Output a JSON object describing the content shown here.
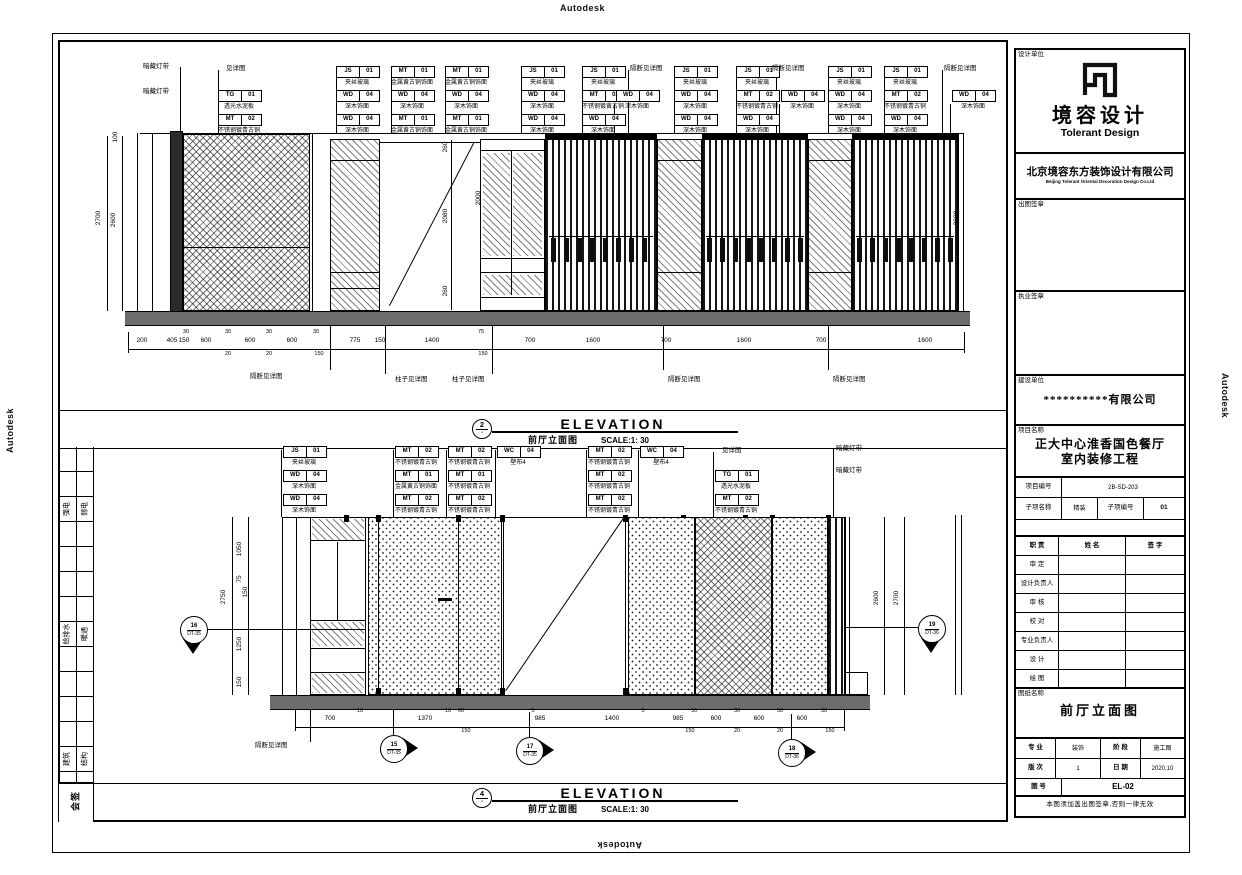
{
  "watermarks": {
    "top": "Autodesk",
    "bottom": "Autodesk",
    "left": "Autodesk",
    "right": "Autodesk"
  },
  "elev1": {
    "title": {
      "num": "2",
      "dash": "-",
      "en": "ELEVATION",
      "zh": "前厅立面图",
      "scale": "SCALE:1: 30"
    },
    "tags": [
      {
        "x": 218,
        "y": 90,
        "code": "TG",
        "num": "01",
        "label": "透光水泥板"
      },
      {
        "x": 218,
        "y": 114,
        "code": "MT",
        "num": "02",
        "label": "不锈钢镀青古铜"
      },
      {
        "x": 336,
        "y": 66,
        "code": "JS",
        "num": "01",
        "label": "夹丝玻璃"
      },
      {
        "x": 336,
        "y": 90,
        "code": "WD",
        "num": "04",
        "label": "深木饰面"
      },
      {
        "x": 336,
        "y": 114,
        "code": "WD",
        "num": "04",
        "label": "深木饰面"
      },
      {
        "x": 391,
        "y": 66,
        "code": "MT",
        "num": "01",
        "label": "金属黄古铜饰面"
      },
      {
        "x": 391,
        "y": 90,
        "code": "WD",
        "num": "04",
        "label": "深木饰面"
      },
      {
        "x": 391,
        "y": 114,
        "code": "MT",
        "num": "01",
        "label": "金属黄古铜饰面"
      },
      {
        "x": 445,
        "y": 66,
        "code": "MT",
        "num": "01",
        "label": "金属黄古铜饰面"
      },
      {
        "x": 445,
        "y": 90,
        "code": "WD",
        "num": "04",
        "label": "深木饰面"
      },
      {
        "x": 445,
        "y": 114,
        "code": "MT",
        "num": "01",
        "label": "金属黄古铜饰面"
      },
      {
        "x": 521,
        "y": 66,
        "code": "JS",
        "num": "01",
        "label": "夹丝玻璃"
      },
      {
        "x": 521,
        "y": 90,
        "code": "WD",
        "num": "04",
        "label": "深木饰面"
      },
      {
        "x": 521,
        "y": 114,
        "code": "WD",
        "num": "04",
        "label": "深木饰面"
      },
      {
        "x": 582,
        "y": 66,
        "code": "JS",
        "num": "01",
        "label": "夹丝玻璃"
      },
      {
        "x": 582,
        "y": 90,
        "code": "MT",
        "num": "02",
        "label": "不锈钢镀黄古铜"
      },
      {
        "x": 582,
        "y": 114,
        "code": "WD",
        "num": "04",
        "label": "深木饰面"
      },
      {
        "x": 616,
        "y": 90,
        "code": "WD",
        "num": "04",
        "label": "深木饰面"
      },
      {
        "x": 674,
        "y": 66,
        "code": "JS",
        "num": "01",
        "label": "夹丝玻璃"
      },
      {
        "x": 674,
        "y": 90,
        "code": "WD",
        "num": "04",
        "label": "深木饰面"
      },
      {
        "x": 674,
        "y": 114,
        "code": "WD",
        "num": "04",
        "label": "深木饰面"
      },
      {
        "x": 736,
        "y": 66,
        "code": "JS",
        "num": "01",
        "label": "夹丝玻璃"
      },
      {
        "x": 736,
        "y": 90,
        "code": "MT",
        "num": "02",
        "label": "不锈钢镀青古铜"
      },
      {
        "x": 736,
        "y": 114,
        "code": "WD",
        "num": "04",
        "label": "深木饰面"
      },
      {
        "x": 781,
        "y": 90,
        "code": "WD",
        "num": "04",
        "label": "深木饰面"
      },
      {
        "x": 828,
        "y": 66,
        "code": "JS",
        "num": "01",
        "label": "夹丝玻璃"
      },
      {
        "x": 828,
        "y": 90,
        "code": "WD",
        "num": "04",
        "label": "深木饰面"
      },
      {
        "x": 828,
        "y": 114,
        "code": "WD",
        "num": "04",
        "label": "深木饰面"
      },
      {
        "x": 884,
        "y": 66,
        "code": "JS",
        "num": "01",
        "label": "夹丝玻璃"
      },
      {
        "x": 884,
        "y": 90,
        "code": "MT",
        "num": "02",
        "label": "不锈钢镀青古铜"
      },
      {
        "x": 884,
        "y": 114,
        "code": "WD",
        "num": "04",
        "label": "深木饰面"
      },
      {
        "x": 952,
        "y": 90,
        "code": "WD",
        "num": "04",
        "label": "深木饰面"
      }
    ],
    "notes": [
      {
        "x": 143,
        "y": 64,
        "t": "暗藏灯带"
      },
      {
        "x": 143,
        "y": 89,
        "t": "暗藏灯带"
      },
      {
        "x": 226,
        "y": 66,
        "t": "见详图"
      },
      {
        "x": 630,
        "y": 66,
        "t": "隔断见详图"
      },
      {
        "x": 772,
        "y": 66,
        "t": "隔断见详图"
      },
      {
        "x": 944,
        "y": 66,
        "t": "隔断见详图"
      }
    ],
    "dims": [
      {
        "x": 142,
        "y": 338,
        "t": "200"
      },
      {
        "x": 172,
        "y": 338,
        "t": "405"
      },
      {
        "x": 184,
        "y": 338,
        "t": "150"
      },
      {
        "x": 206,
        "y": 338,
        "t": "600"
      },
      {
        "x": 250,
        "y": 338,
        "t": "600"
      },
      {
        "x": 292,
        "y": 338,
        "t": "600"
      },
      {
        "x": 355,
        "y": 338,
        "t": "775"
      },
      {
        "x": 380,
        "y": 338,
        "t": "150"
      },
      {
        "x": 432,
        "y": 338,
        "t": "1400"
      },
      {
        "x": 530,
        "y": 338,
        "t": "700"
      },
      {
        "x": 593,
        "y": 338,
        "t": "1600"
      },
      {
        "x": 666,
        "y": 338,
        "t": "700"
      },
      {
        "x": 744,
        "y": 338,
        "t": "1600"
      },
      {
        "x": 821,
        "y": 338,
        "t": "700"
      },
      {
        "x": 925,
        "y": 338,
        "t": "1600"
      },
      {
        "x": 186,
        "y": 330,
        "t": "30",
        "cls": "sm"
      },
      {
        "x": 228,
        "y": 330,
        "t": "30",
        "cls": "sm"
      },
      {
        "x": 269,
        "y": 330,
        "t": "30",
        "cls": "sm"
      },
      {
        "x": 316,
        "y": 330,
        "t": "30",
        "cls": "sm"
      },
      {
        "x": 481,
        "y": 330,
        "t": "75",
        "cls": "sm"
      },
      {
        "x": 228,
        "y": 352,
        "t": "20",
        "cls": "sm"
      },
      {
        "x": 269,
        "y": 352,
        "t": "20",
        "cls": "sm"
      },
      {
        "x": 319,
        "y": 352,
        "t": "150",
        "cls": "sm"
      },
      {
        "x": 483,
        "y": 352,
        "t": "150",
        "cls": "sm"
      }
    ],
    "vdims": [
      {
        "x": 99,
        "y": 218,
        "t": "2700"
      },
      {
        "x": 114,
        "y": 220,
        "t": "2600"
      },
      {
        "x": 116,
        "y": 137,
        "t": "100"
      },
      {
        "x": 446,
        "y": 147,
        "t": "260"
      },
      {
        "x": 446,
        "y": 216,
        "t": "2080"
      },
      {
        "x": 446,
        "y": 291,
        "t": "260"
      },
      {
        "x": 479,
        "y": 198,
        "t": "2000"
      },
      {
        "x": 957,
        "y": 218,
        "t": "2600"
      }
    ],
    "below_notes": [
      {
        "x": 250,
        "y": 374,
        "t": "隔断见详图"
      },
      {
        "x": 395,
        "y": 377,
        "t": "柱子见详图"
      },
      {
        "x": 452,
        "y": 377,
        "t": "柱子见详图"
      },
      {
        "x": 668,
        "y": 377,
        "t": "隔断见详图"
      },
      {
        "x": 833,
        "y": 377,
        "t": "隔断见详图"
      }
    ]
  },
  "elev2": {
    "title": {
      "num": "4",
      "dash": "-",
      "en": "ELEVATION",
      "zh": "前厅立面图",
      "scale": "SCALE:1: 30"
    },
    "tags": [
      {
        "x": 283,
        "y": 446,
        "code": "JS",
        "num": "01",
        "label": "夹丝玻璃"
      },
      {
        "x": 283,
        "y": 470,
        "code": "WD",
        "num": "04",
        "label": "深木饰面"
      },
      {
        "x": 283,
        "y": 494,
        "code": "WD",
        "num": "04",
        "label": "深木饰面"
      },
      {
        "x": 395,
        "y": 446,
        "code": "MT",
        "num": "02",
        "label": "不锈钢镀青古铜"
      },
      {
        "x": 395,
        "y": 470,
        "code": "MT",
        "num": "01",
        "label": "金属黄古铜饰面"
      },
      {
        "x": 395,
        "y": 494,
        "code": "MT",
        "num": "02",
        "label": "不锈钢镀青古铜"
      },
      {
        "x": 448,
        "y": 446,
        "code": "MT",
        "num": "02",
        "label": "不锈钢镀青古铜"
      },
      {
        "x": 448,
        "y": 470,
        "code": "MT",
        "num": "01",
        "label": "不锈钢镀青古铜"
      },
      {
        "x": 448,
        "y": 494,
        "code": "MT",
        "num": "02",
        "label": "不锈钢镀青古铜"
      },
      {
        "x": 497,
        "y": 446,
        "code": "WC",
        "num": "04",
        "label": "壁布4"
      },
      {
        "x": 588,
        "y": 446,
        "code": "MT",
        "num": "02",
        "label": "不锈钢镀青古铜"
      },
      {
        "x": 588,
        "y": 470,
        "code": "MT",
        "num": "02",
        "label": "不锈钢镀青古铜"
      },
      {
        "x": 588,
        "y": 494,
        "code": "MT",
        "num": "02",
        "label": "不锈钢镀青古铜"
      },
      {
        "x": 640,
        "y": 446,
        "code": "WC",
        "num": "04",
        "label": "壁布4"
      },
      {
        "x": 715,
        "y": 470,
        "code": "TG",
        "num": "01",
        "label": "透光水泥板"
      },
      {
        "x": 715,
        "y": 494,
        "code": "MT",
        "num": "02",
        "label": "不锈钢镀青古铜"
      }
    ],
    "notes": [
      {
        "x": 722,
        "y": 448,
        "t": "见详图"
      },
      {
        "x": 836,
        "y": 446,
        "t": "暗藏灯带"
      },
      {
        "x": 836,
        "y": 468,
        "t": "暗藏灯带"
      }
    ],
    "dims": [
      {
        "x": 330,
        "y": 716,
        "t": "700"
      },
      {
        "x": 425,
        "y": 716,
        "t": "1370"
      },
      {
        "x": 540,
        "y": 716,
        "t": "985"
      },
      {
        "x": 612,
        "y": 716,
        "t": "1400"
      },
      {
        "x": 678,
        "y": 716,
        "t": "985"
      },
      {
        "x": 716,
        "y": 716,
        "t": "600"
      },
      {
        "x": 759,
        "y": 716,
        "t": "600"
      },
      {
        "x": 802,
        "y": 716,
        "t": "600"
      },
      {
        "x": 360,
        "y": 709,
        "t": "10",
        "cls": "sm"
      },
      {
        "x": 448,
        "y": 709,
        "t": "10",
        "cls": "sm"
      },
      {
        "x": 461,
        "y": 709,
        "t": "60",
        "cls": "sm"
      },
      {
        "x": 533,
        "y": 709,
        "t": "5",
        "cls": "sm"
      },
      {
        "x": 643,
        "y": 709,
        "t": "5",
        "cls": "sm"
      },
      {
        "x": 694,
        "y": 709,
        "t": "30",
        "cls": "sm"
      },
      {
        "x": 737,
        "y": 709,
        "t": "30",
        "cls": "sm"
      },
      {
        "x": 780,
        "y": 709,
        "t": "30",
        "cls": "sm"
      },
      {
        "x": 824,
        "y": 709,
        "t": "30",
        "cls": "sm"
      },
      {
        "x": 466,
        "y": 729,
        "t": "150",
        "cls": "sm"
      },
      {
        "x": 690,
        "y": 729,
        "t": "150",
        "cls": "sm"
      },
      {
        "x": 737,
        "y": 729,
        "t": "20",
        "cls": "sm"
      },
      {
        "x": 780,
        "y": 729,
        "t": "20",
        "cls": "sm"
      },
      {
        "x": 830,
        "y": 729,
        "t": "150",
        "cls": "sm"
      }
    ],
    "vdims": [
      {
        "x": 224,
        "y": 597,
        "t": "2750"
      },
      {
        "x": 240,
        "y": 549,
        "t": "1050"
      },
      {
        "x": 240,
        "y": 579,
        "t": "75"
      },
      {
        "x": 246,
        "y": 592,
        "t": "150"
      },
      {
        "x": 240,
        "y": 644,
        "t": "1250"
      },
      {
        "x": 240,
        "y": 682,
        "t": "150"
      },
      {
        "x": 877,
        "y": 598,
        "t": "2600"
      },
      {
        "x": 897,
        "y": 598,
        "t": "2700"
      }
    ],
    "below_notes": [
      {
        "x": 255,
        "y": 743,
        "t": "隔断见详图"
      }
    ],
    "callouts": [
      {
        "x": 380,
        "y": 735,
        "num": "15",
        "ref": "DT-35",
        "cls": "dir-right"
      },
      {
        "x": 516,
        "y": 737,
        "num": "17",
        "ref": "DT-35",
        "cls": "dir-right"
      },
      {
        "x": 778,
        "y": 739,
        "num": "18",
        "ref": "DT-36",
        "cls": "dir-right"
      },
      {
        "x": 180,
        "y": 616,
        "num": "16",
        "ref": "DT-35",
        "cls": "dir-down"
      },
      {
        "x": 918,
        "y": 615,
        "num": "19",
        "ref": "DT-36",
        "cls": "dir-down"
      }
    ]
  },
  "signoff": {
    "labels": [
      {
        "x": 67,
        "y": 509,
        "t": "强电"
      },
      {
        "x": 85,
        "y": 509,
        "t": "弱电"
      },
      {
        "x": 67,
        "y": 634,
        "t": "给排水"
      },
      {
        "x": 85,
        "y": 634,
        "t": "暖通"
      },
      {
        "x": 67,
        "y": 759,
        "t": "建筑"
      },
      {
        "x": 85,
        "y": 759,
        "t": "结构"
      },
      {
        "x": 76,
        "y": 801,
        "t": "会签",
        "cls": "big"
      }
    ]
  },
  "title_block": {
    "design_unit_label": "设计单位",
    "logo_cn": "境容设计",
    "logo_en": "Tolerant Design",
    "company_cn": "北京境容东方装饰设计有限公司",
    "company_en": "Beijing Tolerant Oriental Decoration Design Co.Ltd",
    "seal_label": "出图签章",
    "license_seal_label": "执业签章",
    "client_label": "建设单位",
    "client_value": "**********有限公司",
    "project_label": "项目名称",
    "project_line1": "正大中心淮香国色餐厅",
    "project_line2": "室内装修工程",
    "project_no_label": "项目编号",
    "project_no_value": "2B-SD-203",
    "subitem_label": "子项名称",
    "subitem_value": "精装",
    "subitem_no_label": "子项编号",
    "subitem_no_value": "01",
    "roles_header": {
      "role": "职 责",
      "name": "姓 名",
      "sign": "签 字"
    },
    "roles": [
      {
        "label": "审 定"
      },
      {
        "label": "设计负责人"
      },
      {
        "label": "审 核"
      },
      {
        "label": "校 对"
      },
      {
        "label": "专业负责人"
      },
      {
        "label": "设 计"
      },
      {
        "label": "绘 图"
      }
    ],
    "sheet_name_label": "图纸名称",
    "sheet_name": "前厅立面图",
    "specialty_label": "专 业",
    "specialty_value": "装饰",
    "stage_label": "阶 段",
    "stage_value": "施工图",
    "version_label": "版 次",
    "version_value": "1",
    "date_label": "日 期",
    "date_value": "2020.10",
    "sheet_no_label": "图 号",
    "sheet_no_value": "EL-02",
    "note": "本图须加盖出图签章,否则一律无效"
  }
}
